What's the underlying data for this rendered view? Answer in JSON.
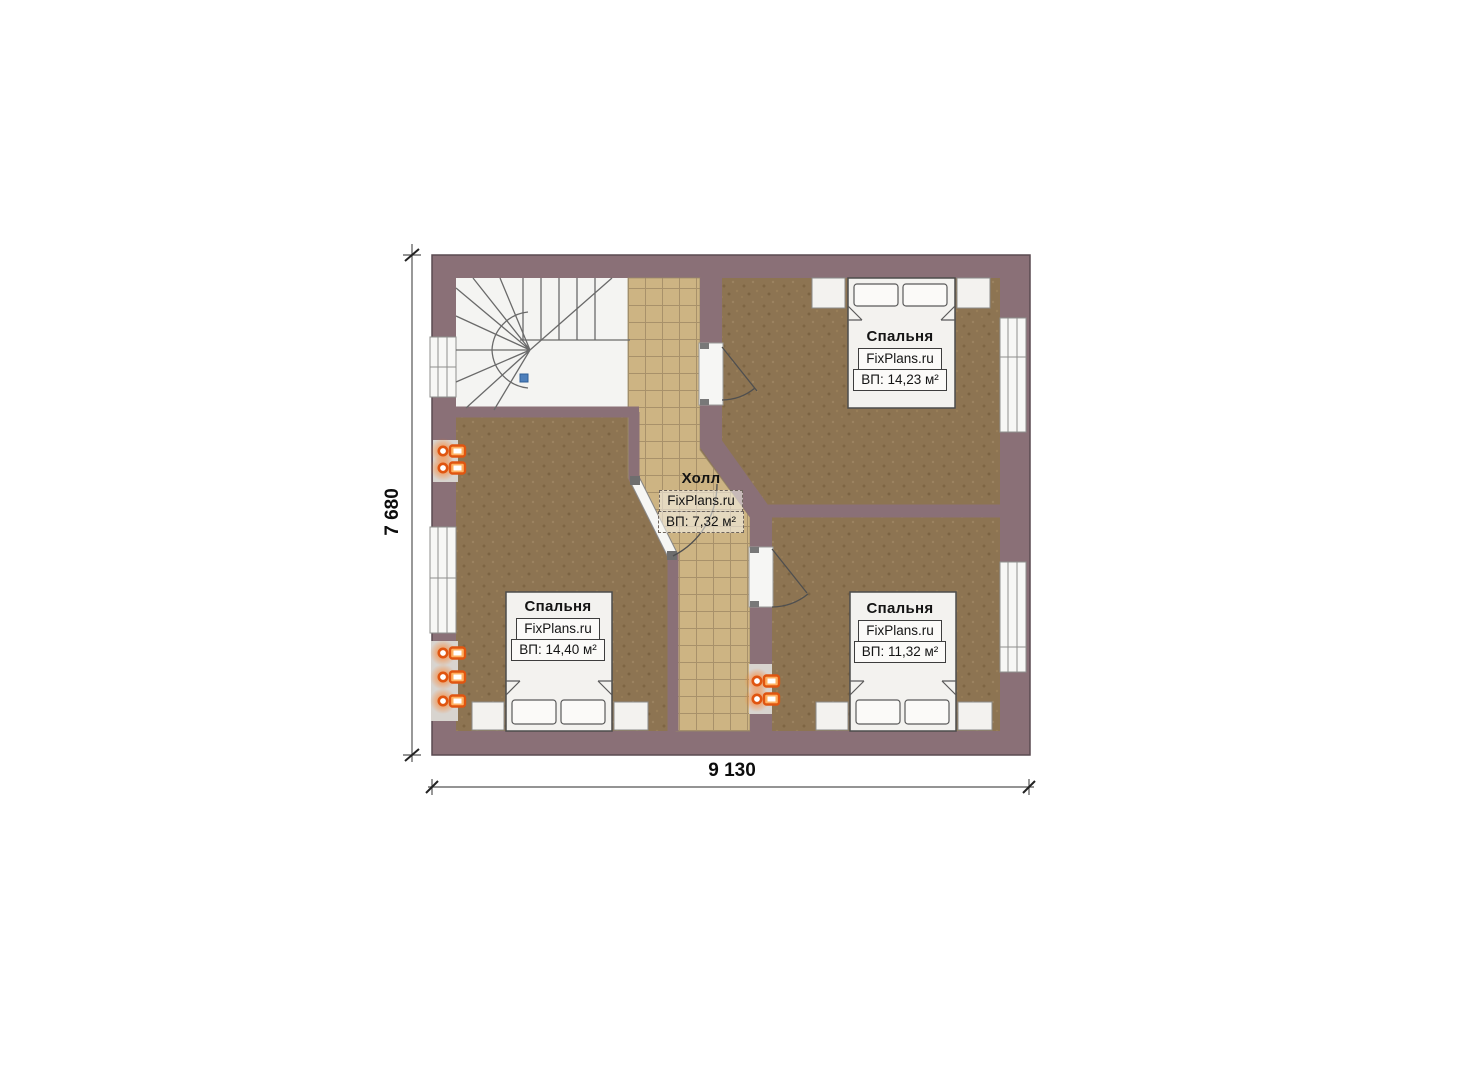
{
  "plan": {
    "brand": "FixPlans.ru",
    "hall": {
      "name": "Холл",
      "brand": "FixPlans.ru",
      "area": "ВП: 7,32 м²"
    },
    "rooms": [
      {
        "name": "Спальня",
        "brand": "FixPlans.ru",
        "area": "ВП: 14,23 м²"
      },
      {
        "name": "Спальня",
        "brand": "FixPlans.ru",
        "area": "ВП: 14,40 м²"
      },
      {
        "name": "Спальня",
        "brand": "FixPlans.ru",
        "area": "ВП: 11,32 м²"
      }
    ],
    "dimensions": {
      "width": "9 130",
      "height": "7 680"
    },
    "colors": {
      "wall": "#8a7077",
      "bedroom_floor": "#8d7452",
      "hall_floor": "#cdb483",
      "stair_floor": "#f4f4f2",
      "radiator": "#e05510",
      "stair_marker": "#4d7fbb"
    }
  }
}
